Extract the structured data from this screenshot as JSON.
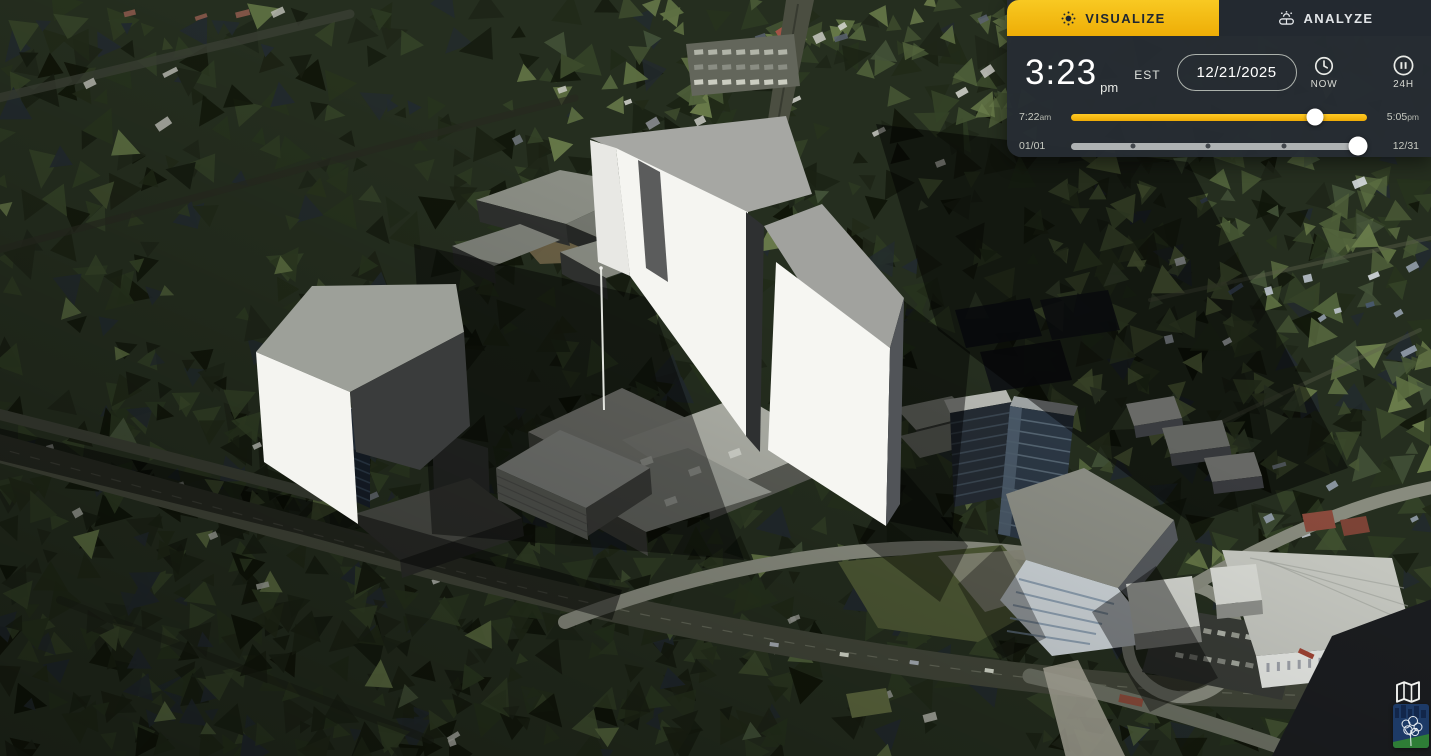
{
  "panel": {
    "tabs": [
      {
        "id": "visualize",
        "label": "VISUALIZE",
        "active": true,
        "icon": "sun-icon"
      },
      {
        "id": "analyze",
        "label": "ANALYZE",
        "active": false,
        "icon": "sun-horizon-icon"
      }
    ],
    "clock": {
      "time": "3:23",
      "meridiem": "pm",
      "timezone": "EST"
    },
    "date_field": {
      "value": "12/21/2025"
    },
    "now_button": {
      "label": "NOW",
      "icon": "clock-icon"
    },
    "loop_button": {
      "label": "24H",
      "icon": "pause-icon"
    },
    "time_slider": {
      "start_label": "7:22",
      "start_suffix": "am",
      "end_label": "5:05",
      "end_suffix": "pm",
      "value_pct": 82.5
    },
    "date_slider": {
      "start_label": "01/01",
      "end_label": "12/31",
      "value_pct": 97,
      "tick_pcts": [
        21,
        46.3,
        72
      ]
    },
    "colors": {
      "accent_yellow": "#f2bb13",
      "panel_bg": "#262c33"
    }
  },
  "corner_icons": [
    {
      "name": "open-map-icon"
    },
    {
      "name": "tree-city-logo"
    }
  ],
  "scene": {
    "description": "3D aerial view: white massing models of proposed towers over a mall site, surrounded by dark evergreen forest, roads, glass towers and white apartment blocks",
    "colors": {
      "forest": "#232b1c",
      "massing_white": "#f5f5f1",
      "massing_roof": "#a6a7a3",
      "shadow": "#000000",
      "road": "#43473a"
    }
  }
}
